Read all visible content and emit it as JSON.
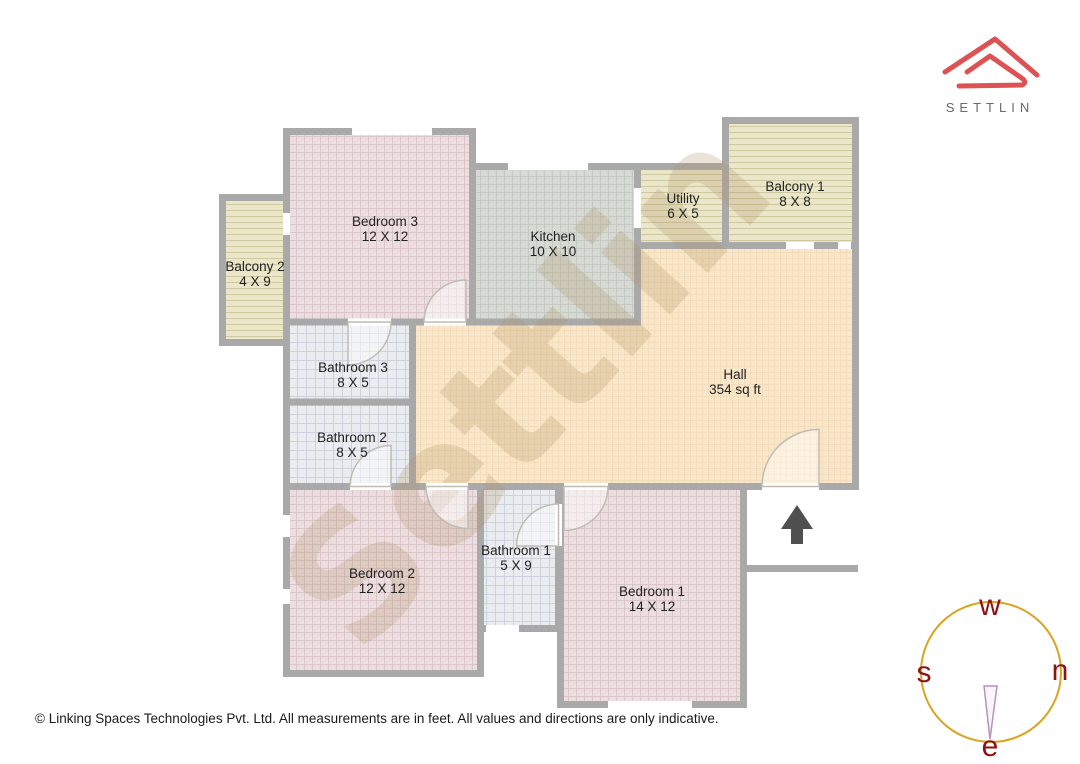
{
  "logo": {
    "brand": "SETTLIN",
    "accent_color": "#dd5353",
    "text_color": "#6a6a6a"
  },
  "watermark": {
    "text": "Settlin"
  },
  "floorplan": {
    "wall_color": "#a9a9a9",
    "entrance_arrow_color": "#4f4f4f",
    "rooms": [
      {
        "id": "bedroom3",
        "name": "Bedroom 3",
        "dims": "12 X 12",
        "fill": "#ecdee0"
      },
      {
        "id": "balcony2",
        "name": "Balcony 2",
        "dims": "4 X 9",
        "fill": "#eae6ca"
      },
      {
        "id": "kitchen",
        "name": "Kitchen",
        "dims": "10 X 10",
        "fill": "#d7dad4"
      },
      {
        "id": "utility",
        "name": "Utility",
        "dims": "6 X 5",
        "fill": "#eae6ca"
      },
      {
        "id": "balcony1",
        "name": "Balcony 1",
        "dims": "8 X 8",
        "fill": "#eae6ca"
      },
      {
        "id": "hall",
        "name": "Hall",
        "dims": "354 sq ft",
        "fill": "#f9e7cb"
      },
      {
        "id": "bathroom3",
        "name": "Bathroom 3",
        "dims": "8 X 5",
        "fill": "#eaecef"
      },
      {
        "id": "bathroom2",
        "name": "Bathroom 2",
        "dims": "8 X 5",
        "fill": "#eaecef"
      },
      {
        "id": "bedroom2",
        "name": "Bedroom 2",
        "dims": "12 X 12",
        "fill": "#ecdee0"
      },
      {
        "id": "bathroom1",
        "name": "Bathroom 1",
        "dims": "5 X 9",
        "fill": "#eaecef"
      },
      {
        "id": "bedroom1",
        "name": "Bedroom 1",
        "dims": "14 X 12",
        "fill": "#ecdee0"
      }
    ]
  },
  "compass": {
    "letters": {
      "top": "w",
      "left": "s",
      "right": "n",
      "bottom": "e"
    },
    "circle_color": "#d9a521",
    "letter_color": "#8f1111",
    "needle_color": "#b694b6"
  },
  "footer": {
    "copyright": "© Linking Spaces Technologies Pvt. Ltd. All measurements are in feet. All values and directions are only indicative."
  }
}
